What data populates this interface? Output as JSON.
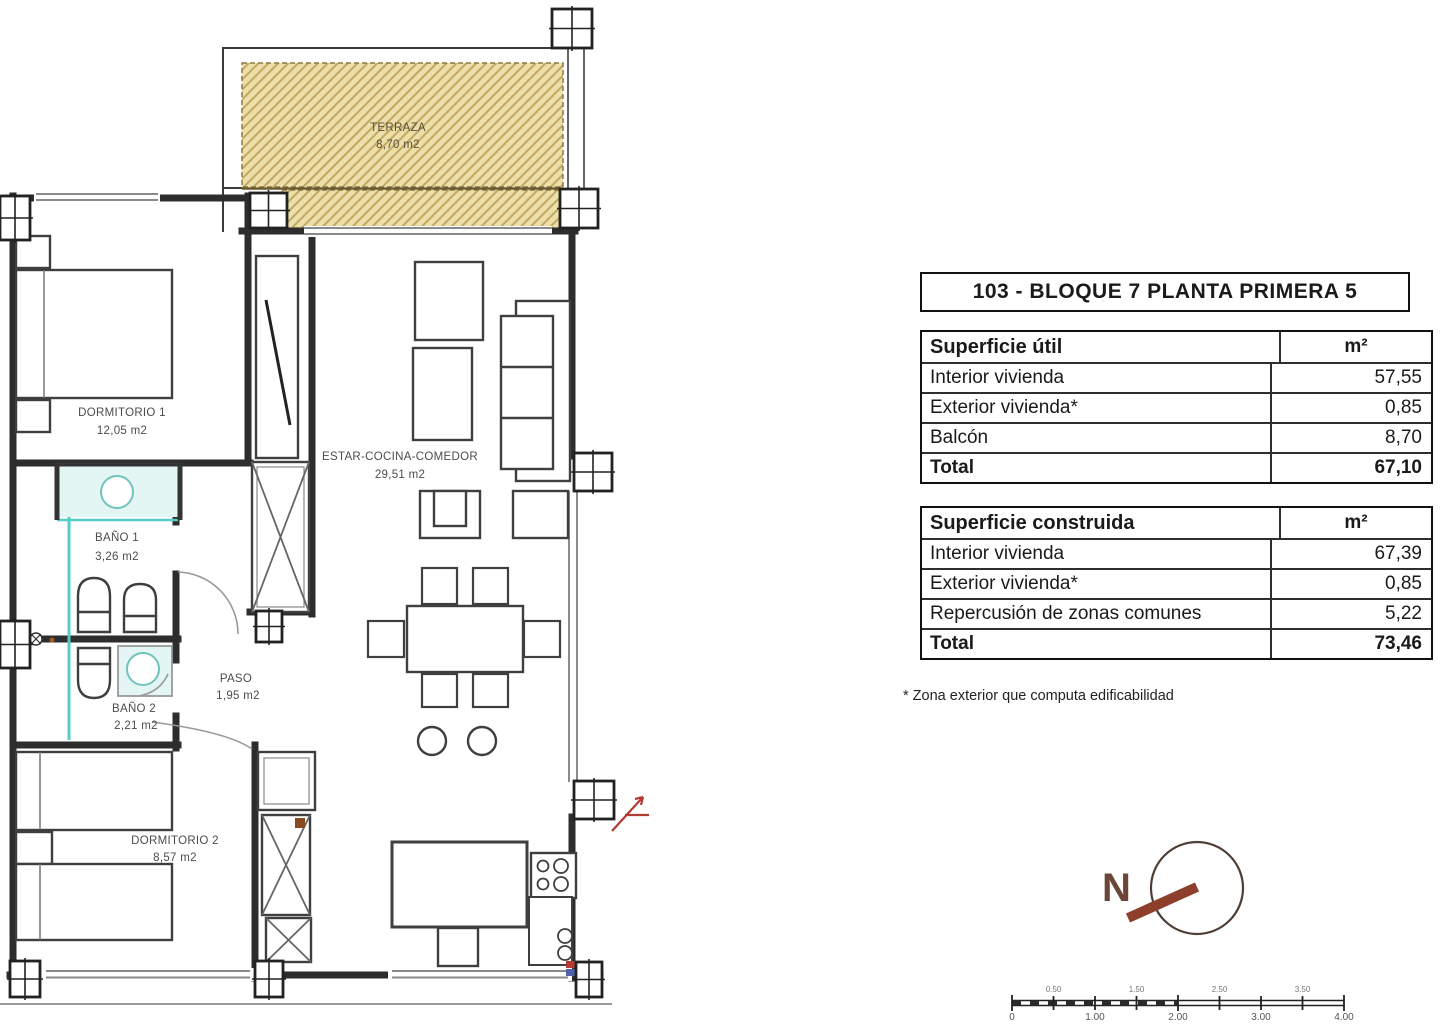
{
  "title": "103 - BLOQUE 7 PLANTA PRIMERA 5",
  "tables": {
    "util": {
      "header": "Superficie útil",
      "unit": "m²",
      "rows": [
        {
          "label": "Interior vivienda",
          "value": "57,55"
        },
        {
          "label": "Exterior vivienda*",
          "value": "0,85"
        },
        {
          "label": "Balcón",
          "value": "8,70"
        }
      ],
      "total_label": "Total",
      "total_value": "67,10"
    },
    "construida": {
      "header": "Superficie construida",
      "unit": "m²",
      "rows": [
        {
          "label": "Interior vivienda",
          "value": "67,39"
        },
        {
          "label": "Exterior vivienda*",
          "value": "0,85"
        },
        {
          "label": "Repercusión de zonas comunes",
          "value": "5,22"
        }
      ],
      "total_label": "Total",
      "total_value": "73,46"
    }
  },
  "footnote": "* Zona exterior que computa edificabilidad",
  "compass": {
    "label": "N"
  },
  "scale_bar": {
    "top_labels": [
      "0.50",
      "1.50",
      "2.50",
      "3.50"
    ],
    "bottom_labels": [
      "0",
      "1.00",
      "2.00",
      "3.00",
      "4.00"
    ]
  },
  "plan": {
    "rooms": [
      {
        "name": "TERRAZA",
        "area": "8,70 m2"
      },
      {
        "name": "DORMITORIO 1",
        "area": "12,05 m2"
      },
      {
        "name": "BAÑO 1",
        "area": "3,26 m2"
      },
      {
        "name": "BAÑO 2",
        "area": "2,21 m2"
      },
      {
        "name": "PASO",
        "area": "1,95 m2"
      },
      {
        "name": "ESTAR-COCINA-COMEDOR",
        "area": "29,51 m2"
      },
      {
        "name": "DORMITORIO 2",
        "area": "8,57 m2"
      }
    ],
    "colors": {
      "terraza_fill": "#ecdfa9",
      "hatch_line": "#c2a861",
      "plumbing": "#55cdc7",
      "wall": "#2d2d2d",
      "compass": "#8d3f2b"
    }
  }
}
